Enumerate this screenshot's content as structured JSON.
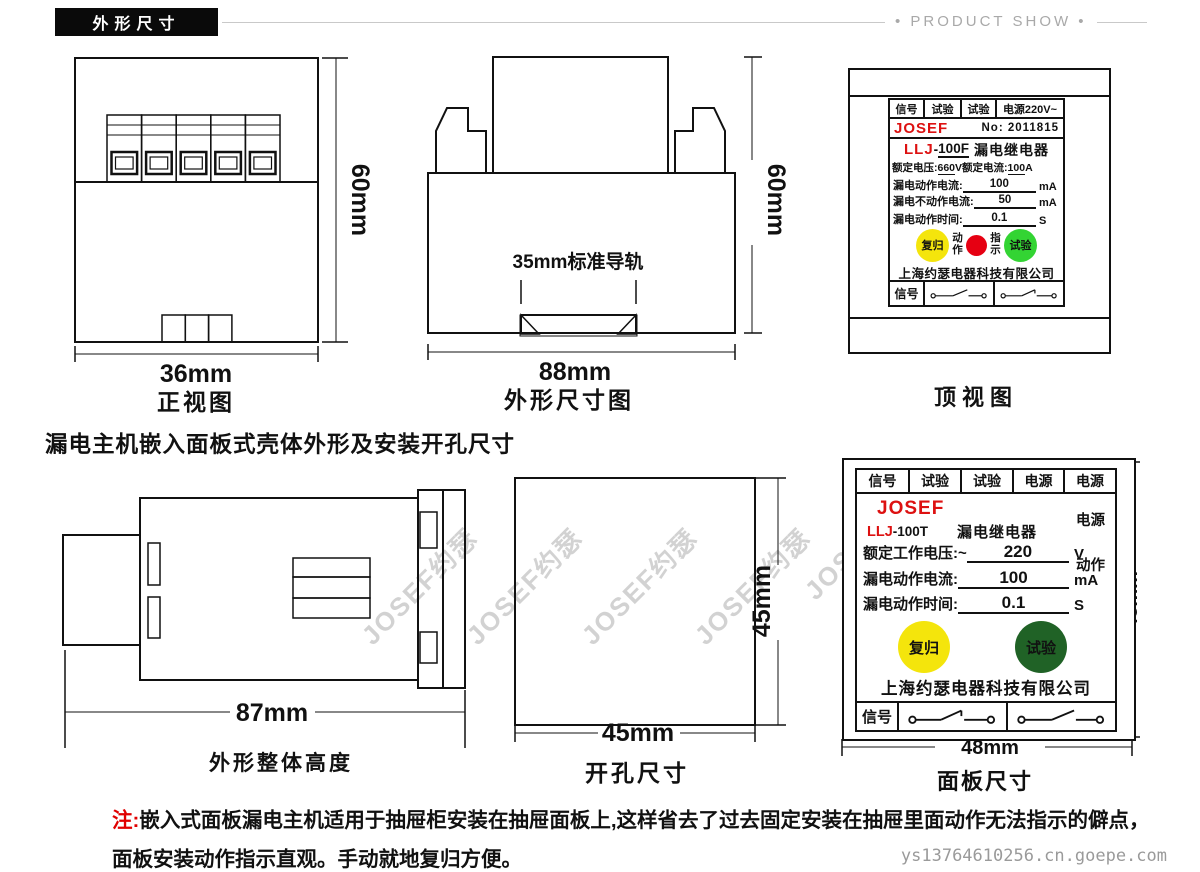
{
  "page": {
    "section_title": "外形尺寸",
    "product_show": "• PRODUCT SHOW •",
    "watermark": "JOSEF约瑟",
    "url": "ys13764610256.cn.goepe.com",
    "heading2": "漏电主机嵌入面板式壳体外形及安装开孔尺寸",
    "note_prefix": "注:",
    "note_line1": "嵌入式面板漏电主机适用于抽屉柜安装在抽屉面板上,这样省去了过去固定安装在抽屉里面动作无法指示的僻点，",
    "note_line2": "面板安装动作指示直观。手动就地复归方便。"
  },
  "front_view": {
    "width": "36mm",
    "height": "60mm",
    "caption": "正视图"
  },
  "side_view": {
    "rail": "35mm标准导轨",
    "width": "88mm",
    "height": "60mm",
    "caption": "外形尺寸图"
  },
  "top_view": {
    "caption": "顶视图",
    "header": [
      "信号",
      "试验",
      "试验",
      "电源220V~"
    ],
    "brand": "JOSEF",
    "no_label": "No:",
    "no_value": "2011815",
    "model": "LLJ",
    "model_dash": "-",
    "model_num": "100F",
    "product": "漏电继电器",
    "spec1_label": "额定电压:",
    "spec1_value": "660",
    "spec1_unit": "V",
    "spec2_label": "额定电流:",
    "spec2_value": "100",
    "spec2_unit": "A",
    "rows": [
      {
        "label": "漏电动作电流:",
        "value": "100",
        "unit": "mA"
      },
      {
        "label": "漏电不动作电流:",
        "value": "50",
        "unit": "mA"
      },
      {
        "label": "漏电动作时间:",
        "value": "0.1",
        "unit": "S"
      }
    ],
    "btn_reset": "复归",
    "lbl_action": "动作",
    "lbl_indicate": "指示",
    "btn_test": "试验",
    "company": "上海约瑟电器科技有限公司",
    "footer_signal": "信号"
  },
  "height_view": {
    "width": "87mm",
    "caption": "外形整体高度"
  },
  "cutout": {
    "width": "45mm",
    "height": "45mm",
    "caption": "开孔尺寸"
  },
  "panel": {
    "caption": "面板尺寸",
    "header": [
      "信号",
      "试验",
      "试验",
      "电源",
      "电源"
    ],
    "brand": "JOSEF",
    "model": "LLJ",
    "model_suffix": "-100T",
    "product": "漏电继电器",
    "side_power": "电源",
    "side_action": "动作",
    "rows": [
      {
        "label": "额定工作电压:~",
        "value": "220",
        "unit": "V"
      },
      {
        "label": "漏电动作电流:",
        "value": "100",
        "unit": "mA"
      },
      {
        "label": "漏电动作时间:",
        "value": "0.1",
        "unit": "S"
      }
    ],
    "btn_reset": "复归",
    "btn_test": "试验",
    "company": "上海约瑟电器科技有限公司",
    "footer_signal": "信号",
    "dim_bottom": "48mm",
    "dim_right": "48mm"
  },
  "colors": {
    "accent_red": "#dd1111",
    "button_yellow": "#f4e50c",
    "button_green": "#33d433",
    "button_dark_green": "#206226",
    "indicator_red": "#e60012"
  }
}
